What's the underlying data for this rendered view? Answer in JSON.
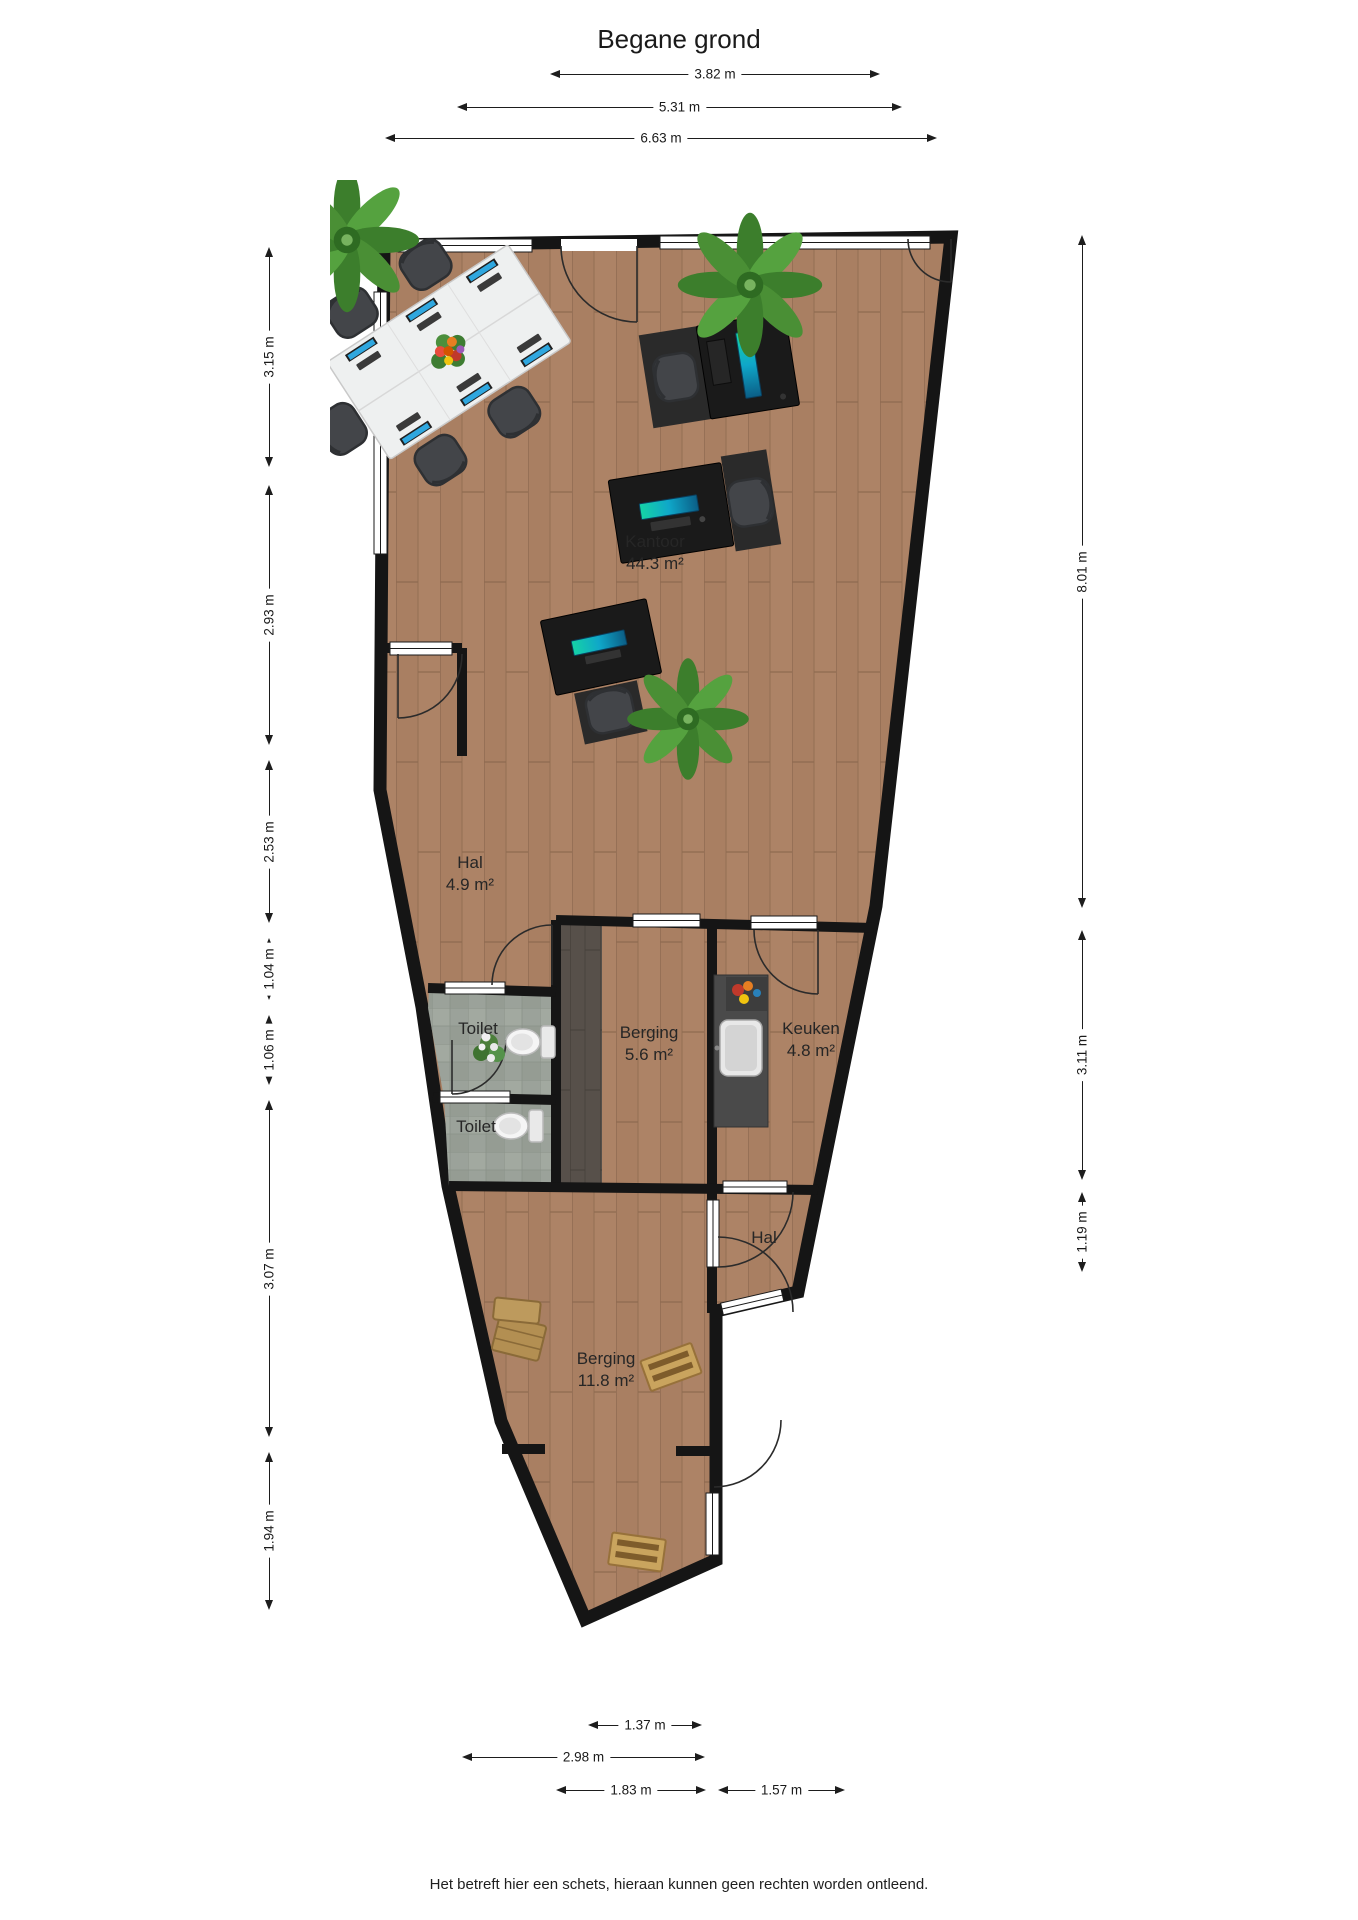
{
  "title": "Begane grond",
  "footer": "Het betreft hier een schets, hieraan kunnen geen rechten worden ontleend.",
  "rooms": {
    "kantoor": {
      "name": "Kantoor",
      "area": "44.3 m²"
    },
    "hal1": {
      "name": "Hal",
      "area": "4.9 m²"
    },
    "toilet1": {
      "name": "Toilet"
    },
    "toilet2": {
      "name": "Toilet"
    },
    "berging1": {
      "name": "Berging",
      "area": "5.6 m²"
    },
    "keuken": {
      "name": "Keuken",
      "area": "4.8 m²"
    },
    "hal2": {
      "name": "Hal"
    },
    "berging2": {
      "name": "Berging",
      "area": "11.8 m²"
    }
  },
  "dimensions": {
    "top": [
      {
        "label": "3.82 m"
      },
      {
        "label": "5.31 m"
      },
      {
        "label": "6.63 m"
      }
    ],
    "left": [
      {
        "label": "3.15 m"
      },
      {
        "label": "2.93 m"
      },
      {
        "label": "2.53 m"
      },
      {
        "label": "1.04 m"
      },
      {
        "label": "1.06 m"
      },
      {
        "label": "3.07 m"
      },
      {
        "label": "1.94 m"
      }
    ],
    "right": [
      {
        "label": "8.01 m"
      },
      {
        "label": "3.11 m"
      },
      {
        "label": "1.19 m"
      }
    ],
    "bottom": [
      {
        "label": "1.37 m"
      },
      {
        "label": "2.98 m"
      },
      {
        "label": "1.83 m"
      },
      {
        "label": "1.57 m"
      }
    ]
  },
  "colors": {
    "wall": "#151515",
    "floor_wood": "#ad8366",
    "floor_wood_dark": "#57504a",
    "floor_tile": "#9ba29a",
    "screen_accent": "#15d3a6",
    "monitor_blue": "#2fa7df",
    "plant_green": "#3f8f2f"
  }
}
